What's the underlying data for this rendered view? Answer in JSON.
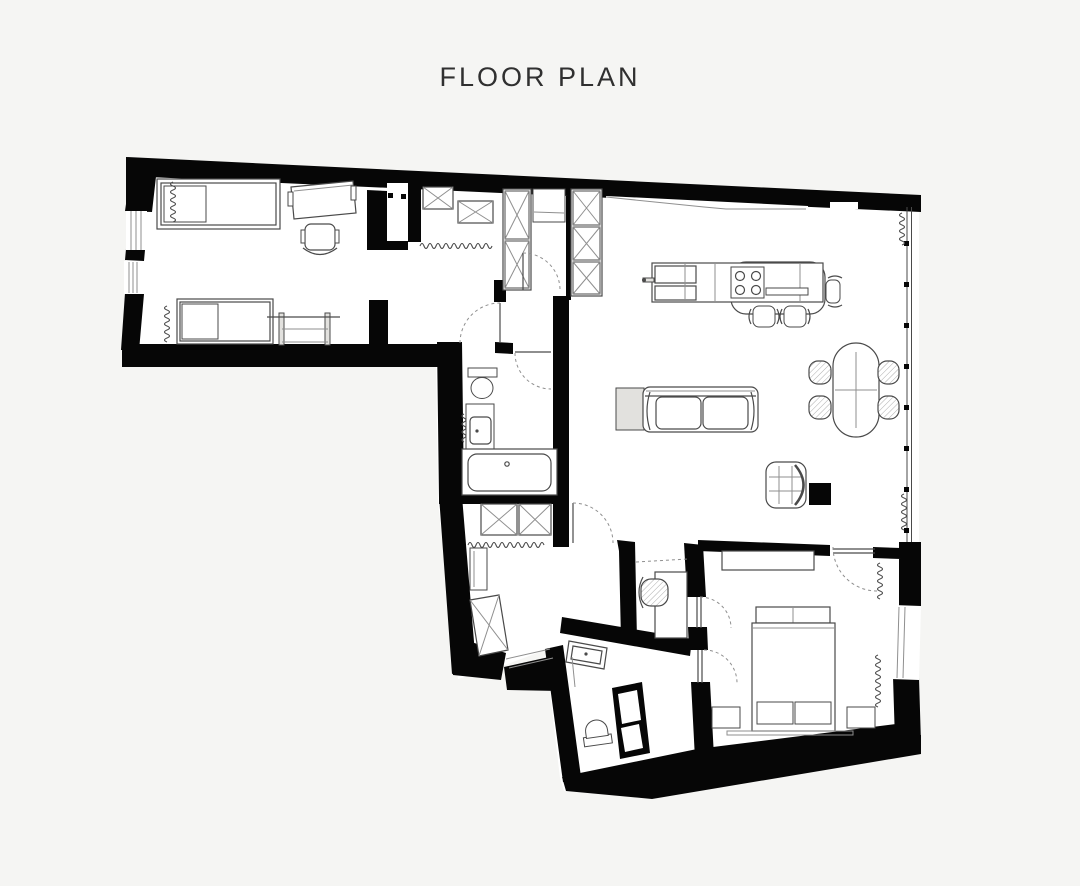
{
  "title": "FLOOR PLAN",
  "colors": {
    "background": "#f5f5f3",
    "wall": "#060606",
    "floor": "#ffffff",
    "line": "#4a4a4a",
    "line_light": "#8f8f8f",
    "fill_light": "#e2e1de",
    "title_color": "#303030"
  },
  "drawing": {
    "type": "architectural-floor-plan",
    "rooms": [
      {
        "name": "bedroom-second",
        "furniture": [
          "single-bed",
          "single-bed",
          "desk",
          "desk-chair",
          "clothes-rack",
          "radiator",
          "radiator",
          "window-wall"
        ]
      },
      {
        "name": "entry-hall",
        "furniture": [
          "overhead-cabinet",
          "overhead-cabinet",
          "coat-rail",
          "closet-column",
          "console",
          "tall-wardrobe",
          "entry-door"
        ]
      },
      {
        "name": "bathroom-main",
        "furniture": [
          "toilet",
          "washbasin-vanity",
          "bathtub",
          "towel-radiator",
          "door",
          "vestibule-door"
        ]
      },
      {
        "name": "kitchen",
        "furniture": [
          "island-counter",
          "sink-unit",
          "cooktop-four-burners",
          "bar-stool",
          "bar-stool",
          "bar-stool",
          "faucet"
        ]
      },
      {
        "name": "living-dining",
        "furniture": [
          "two-seat-sofa",
          "side-table",
          "oval-dining-table",
          "dining-chair",
          "dining-chair",
          "dining-chair",
          "dining-chair",
          "armchair",
          "black-cube-table",
          "glazed-facade",
          "radiator",
          "radiator"
        ]
      },
      {
        "name": "dressing-corridor",
        "furniture": [
          "wardrobe-cabinet",
          "wardrobe-cabinet",
          "coat-rail",
          "mirror-cabinet",
          "angled-wardrobe",
          "threshold-step",
          "door"
        ]
      },
      {
        "name": "study-nook",
        "furniture": [
          "desk",
          "desk-chair",
          "sliding-track"
        ]
      },
      {
        "name": "bathroom-second",
        "furniture": [
          "washbasin",
          "toilet",
          "shower-partition",
          "door"
        ]
      },
      {
        "name": "master-bedroom",
        "furniture": [
          "double-bed",
          "pillow-row",
          "foot-cushion",
          "foot-cushion",
          "nightstand",
          "nightstand",
          "dresser",
          "rug",
          "radiator",
          "radiator",
          "window",
          "door-to-living",
          "door-to-nook",
          "door-to-bath"
        ]
      }
    ]
  }
}
